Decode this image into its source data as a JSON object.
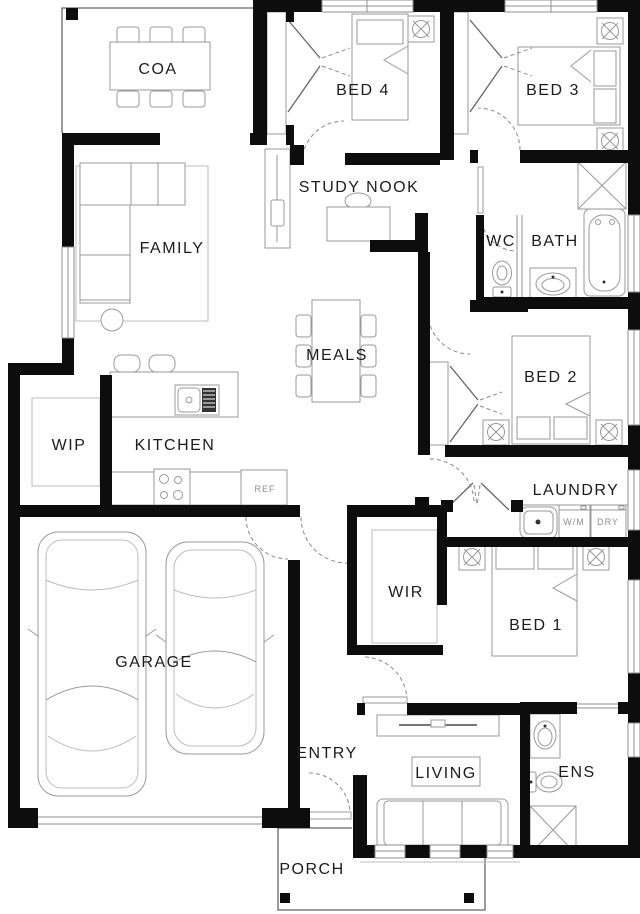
{
  "rooms": {
    "coa": "COA",
    "bed4": "BED 4",
    "bed3": "BED 3",
    "study_nook": "STUDY NOOK",
    "family": "FAMILY",
    "wc": "WC",
    "bath": "BATH",
    "meals": "MEALS",
    "bed2": "BED 2",
    "wip": "WIP",
    "kitchen": "KITCHEN",
    "laundry": "LAUNDRY",
    "wir": "WIR",
    "bed1": "BED 1",
    "garage": "GARAGE",
    "entry": "ENTRY",
    "living": "LIVING",
    "ens": "ENS",
    "porch": "PORCH"
  },
  "appliances": {
    "fridge": "REF",
    "washer": "W/M",
    "dryer": "DRY"
  },
  "colors": {
    "wall": "#0d0d0d",
    "line": "#9a9a9a",
    "label": "#1c1c1c",
    "bg": "#ffffff"
  }
}
